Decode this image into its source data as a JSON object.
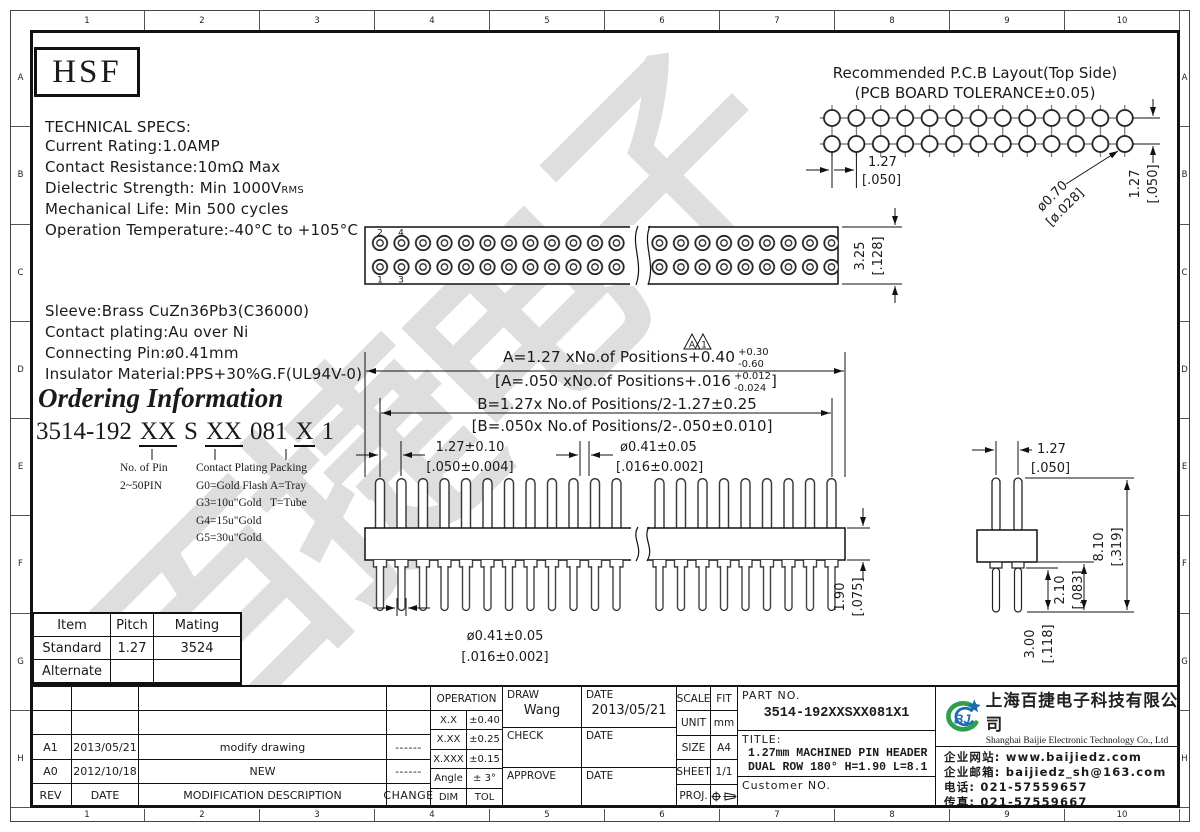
{
  "frame": {
    "columns": [
      "1",
      "2",
      "3",
      "4",
      "5",
      "6",
      "7",
      "8",
      "9",
      "10"
    ],
    "rows": [
      "A",
      "B",
      "C",
      "D",
      "E",
      "F",
      "G",
      "H"
    ]
  },
  "logo": {
    "text": "HSF"
  },
  "tech_specs": {
    "title": "TECHNICAL SPECS:",
    "lines": [
      {
        "t": "Current Rating:1.0AMP",
        "sub": ""
      },
      {
        "t": "Contact Resistance:10mΩ Max",
        "sub": ""
      },
      {
        "t": "Dielectric Strength: Min 1000V",
        "sub": "RMS"
      },
      {
        "t": "Mechanical Life: Min 500 cycles",
        "sub": ""
      },
      {
        "t": "Operation Temperature:-40°C to +105°C",
        "sub": ""
      }
    ]
  },
  "materials": {
    "lines": [
      "Sleeve:Brass CuZn36Pb3(C36000)",
      "Contact plating:Au over Ni",
      "Connecting Pin:ø0.41mm",
      "Insulator Material:PPS+30%G.F(UL94V-0)"
    ]
  },
  "ordering": {
    "title": "Ordering Information",
    "pn": {
      "base": "3514-192",
      "pins": "XX",
      "sep": "S",
      "plating": "XX",
      "code": "081",
      "packing": "X",
      "tail": "1"
    },
    "col1": [
      "No. of Pin",
      "2~50PIN"
    ],
    "col2": [
      "Contact Plating",
      "G0=Gold Flash",
      "G3=10u\"Gold",
      "G4=15u\"Gold",
      "G5=30u\"Gold"
    ],
    "col3": [
      "Packing",
      "A=Tray",
      "T=Tube"
    ]
  },
  "pcb": {
    "title1": "Recommended P.C.B Layout(Top Side)",
    "title2": "(PCB BOARD TOLERANCE±0.05)",
    "pitch": "1.27",
    "pitch_in": "[.050]",
    "hole": "ø0.70",
    "hole_in": "[ø.028]",
    "vpitch": "1.27",
    "vpitch_in": "[.050]"
  },
  "top_view": {
    "p2": "2",
    "p4": "4",
    "p1": "1",
    "p3": "3",
    "h": "3.25",
    "h_in": "[.128]"
  },
  "formulas": {
    "a1": "A=1.27 xNo.of Positions+0.40",
    "a1_sup": "+0.30",
    "a1_sub": "-0.60",
    "a2": "[A=.050 xNo.of Positions+.016",
    "a2_sup": "+0.012",
    "a2_sub": "-0.024",
    "a2_close": "]",
    "b1": "B=1.27x No.of Positions/2-1.27±0.25",
    "b2": "[B=.050x No.of Positions/2-.050±0.010]",
    "flag_a": "A",
    "flag_1": "1"
  },
  "dims": {
    "pitch": "1.27±0.10",
    "pitch_in": "[.050±0.004]",
    "dia": "ø0.41±0.05",
    "dia_in": "[.016±0.002]",
    "body": "1.90",
    "body_in": "[.075]",
    "s_pitch": "1.27",
    "s_pitch_in": "[.050]",
    "total": "8.10",
    "total_in": "[.319]",
    "tail_a": "2.10",
    "tail_a_in": "[.083]",
    "tail_b": "3.00",
    "tail_b_in": "[.118]"
  },
  "mating": {
    "headers": [
      "Item",
      "Pitch",
      "Mating"
    ],
    "rows": [
      [
        "Standard",
        "1.27",
        "3524"
      ],
      [
        "Alternate",
        "",
        ""
      ]
    ]
  },
  "revisions": {
    "rows": [
      {
        "rev": "",
        "date": "",
        "desc": "",
        "chg": ""
      },
      {
        "rev": "",
        "date": "",
        "desc": "",
        "chg": ""
      },
      {
        "rev": "A1",
        "date": "2013/05/21",
        "desc": "modify drawing",
        "chg": "------"
      },
      {
        "rev": "A0",
        "date": "2012/10/18",
        "desc": "NEW",
        "chg": "------"
      },
      {
        "rev": "REV",
        "date": "DATE",
        "desc": "MODIFICATION DESCRIPTION",
        "chg": "CHANGE"
      }
    ]
  },
  "tolerances": {
    "header": "OPERATION",
    "rows": [
      [
        "X.X",
        "±0.40"
      ],
      [
        "X.XX",
        "±0.25"
      ],
      [
        "X.XXX",
        "±0.15"
      ],
      [
        "Angle",
        "± 3°"
      ],
      [
        "DIM",
        "TOL"
      ]
    ]
  },
  "signoff": {
    "draw": "DRAW",
    "draw_name": "Wang",
    "date1": "DATE",
    "date1_val": "2013/05/21",
    "check": "CHECK",
    "date2": "DATE",
    "approve": "APPROVE",
    "date3": "DATE"
  },
  "info": {
    "rows": [
      [
        "SCALE",
        "FIT"
      ],
      [
        "UNIT",
        "mm"
      ],
      [
        "SIZE",
        "A4"
      ],
      [
        "SHEET",
        "1/1"
      ]
    ],
    "proj_label": "PROJ."
  },
  "part": {
    "label": "PART NO.",
    "number": "3514-192XXSXX081X1",
    "title_label": "TITLE:",
    "title1": "1.27mm MACHINED PIN HEADER",
    "title2": "DUAL ROW 180° H=1.90 L=8.1",
    "customer": "Customer NO."
  },
  "company": {
    "logo": "BJ",
    "cn": "上海百捷电子科技有限公司",
    "en": "Shanghai Baijie Electronic Technology Co., Ltd",
    "lines": [
      "企业网站: www.baijiedz.com",
      "企业邮箱: baijiedz_sh@163.com",
      "电话: 021-57559657",
      "传真: 021-57559667"
    ]
  },
  "watermark": "百捷电子",
  "colors": {
    "line": "#1a1a1a",
    "green": "#2ca04a",
    "blue": "#1d6ab5"
  }
}
